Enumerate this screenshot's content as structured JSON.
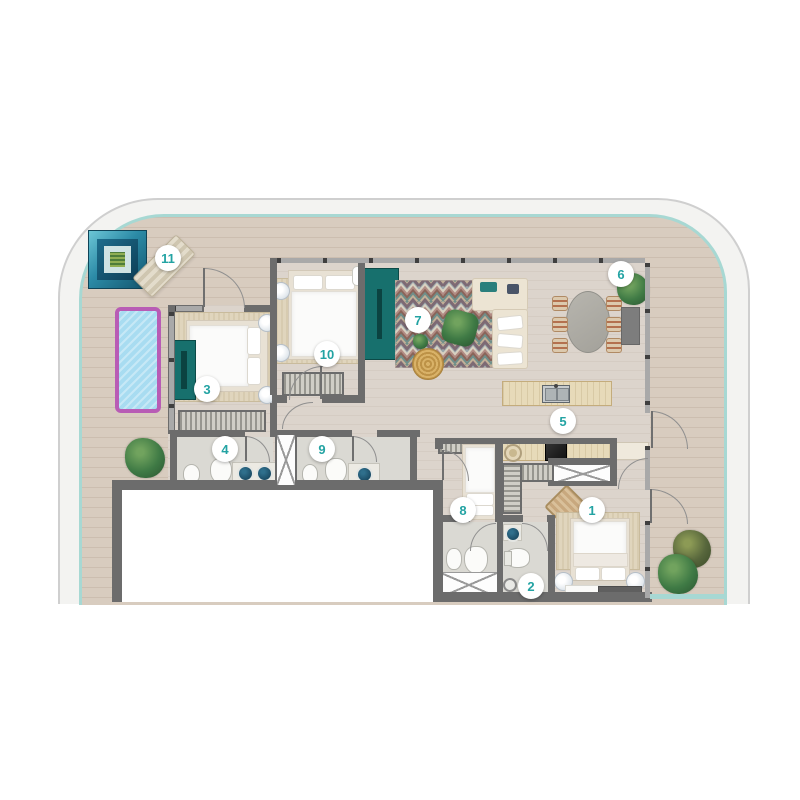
{
  "markers": [
    {
      "label": "1"
    },
    {
      "label": "2"
    },
    {
      "label": "3"
    },
    {
      "label": "4"
    },
    {
      "label": "5"
    },
    {
      "label": "6"
    },
    {
      "label": "7"
    },
    {
      "label": "8"
    },
    {
      "label": "9"
    },
    {
      "label": "10"
    },
    {
      "label": "11"
    }
  ],
  "colors": {
    "accent": "#23a3a3",
    "wall": "#6c6c6c",
    "terrace_wood": "#d8ccbf",
    "interior_floor": "#dcd4cc",
    "bathroom_floor": "#dad9d3",
    "glass_rail": "#a7d8d3",
    "pool_water": "#a8dcf1",
    "pool_border": "#b85cb5",
    "teal_furniture": "#17706d",
    "sofa_cream": "#ece4d3",
    "kitchen_wood": "#e7dab9",
    "rug_beige": "#e0d5bd",
    "plant_green": "#3f7a45",
    "marker_bg": "#ffffff"
  }
}
